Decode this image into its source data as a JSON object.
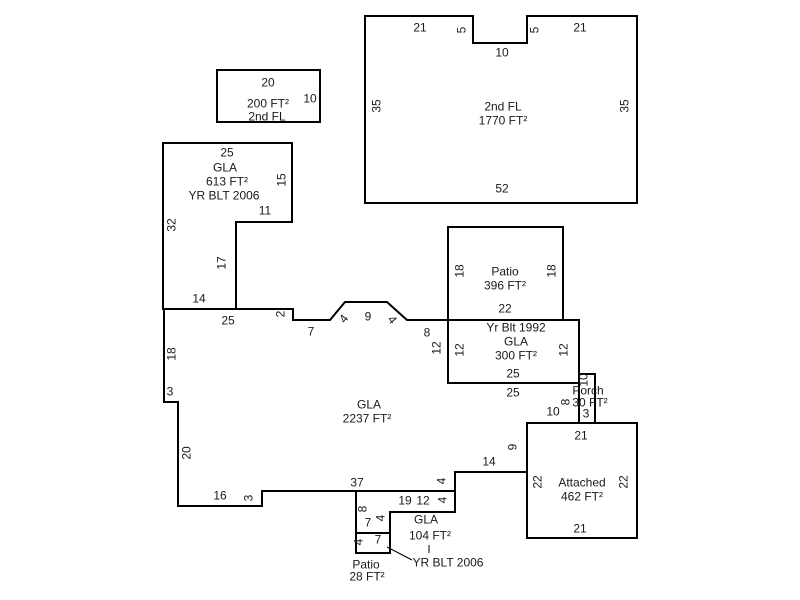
{
  "diagram": {
    "kind": "floor-plan-sketch",
    "background": "#ffffff",
    "line_color": "#000000",
    "text_color": "#1a1a1a"
  },
  "shapes": {
    "second_floor_main": {
      "title": "2nd FL",
      "area": "1770 FT²",
      "dims": {
        "top_left": "21",
        "notch_left": "5",
        "notch_bottom": "10",
        "notch_right": "5",
        "top_right": "21",
        "left": "35",
        "right": "35",
        "bottom": "52"
      }
    },
    "second_floor_small": {
      "title": "2nd FL",
      "area": "200 FT²",
      "dims": {
        "top": "20",
        "right": "10"
      }
    },
    "gla_613": {
      "title": "GLA",
      "area": "613 FT²",
      "year": "YR BLT 2006",
      "dims": {
        "top": "25",
        "right": "15",
        "inner_bottom": "11",
        "left": "32",
        "inner_right": "17",
        "bottom": "14"
      }
    },
    "gla_main": {
      "title": "GLA",
      "area": "2237 FT²",
      "dims": {
        "top": "25",
        "step": "2",
        "ledge": "7",
        "bay_left": "4",
        "bay_top": "9",
        "bay_right": "4",
        "right_ledge": "8",
        "right_upper": "12",
        "right_mid": "25",
        "porch_side": "8",
        "garage_top": "10",
        "garage_side": "9",
        "step_top": "14",
        "step_side": "4",
        "bottom": "37",
        "bottom_step": "3",
        "bottom_left": "16",
        "left_lower": "20",
        "left_step": "3",
        "left_upper": "18"
      }
    },
    "patio_396": {
      "title": "Patio",
      "area": "396 FT²",
      "dims": {
        "left": "18",
        "right": "18",
        "bottom": "22"
      }
    },
    "gla_300": {
      "year": "Yr Blt 1992",
      "title": "GLA",
      "area": "300 FT²",
      "dims": {
        "left": "12",
        "right": "12",
        "bottom": "25"
      }
    },
    "porch": {
      "title": "Porch",
      "area": "30 FT²",
      "dims": {
        "side": "10",
        "bottom": "3"
      }
    },
    "attached": {
      "title": "Attached",
      "area": "462 FT²",
      "dims": {
        "top": "21",
        "left": "22",
        "right": "22",
        "bottom": "21"
      }
    },
    "gla_104": {
      "title": "GLA",
      "area": "104 FT²",
      "year": "YR BLT 2006",
      "dims": {
        "top": "19",
        "mid": "12",
        "step_right": "4",
        "left": "8",
        "inner_bottom": "7",
        "inner_right": "4"
      }
    },
    "patio_28": {
      "title": "Patio",
      "area": "28 FT²",
      "dims": {
        "left": "4",
        "top": "7"
      }
    }
  }
}
